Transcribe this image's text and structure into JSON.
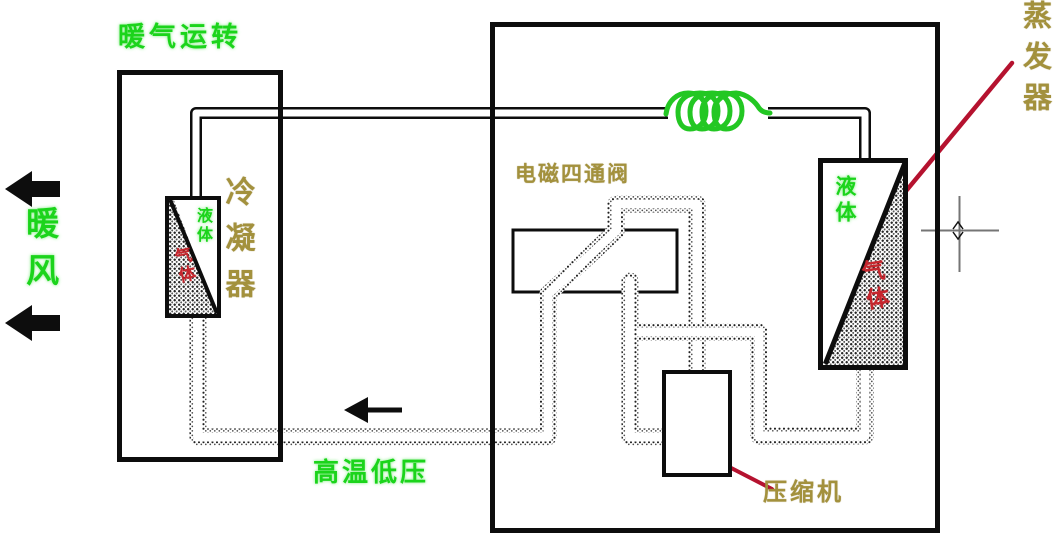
{
  "diagram": {
    "title": "暖气运转",
    "type": "heat-pump-heating-cycle-schematic"
  },
  "labels": {
    "mode_title": "暖气运转",
    "warm_air": "暖风",
    "condenser": "冷凝器",
    "four_way_valve": "电磁四通阀",
    "evaporator": "蒸发器",
    "compressor": "压缩机",
    "bottom_state": "高温低压",
    "condenser_liquid": "液体",
    "condenser_gas": "气体",
    "evaporator_liquid": "液体",
    "evaporator_gas": "气体"
  },
  "colors": {
    "label_green": "#1bd41b",
    "label_olive": "#a3913d",
    "label_red": "#c7252d",
    "annotation_red": "#b5122f",
    "coil_green": "#23c723",
    "line_black": "#0d0d0d",
    "crosshair_gray": "#757575"
  }
}
